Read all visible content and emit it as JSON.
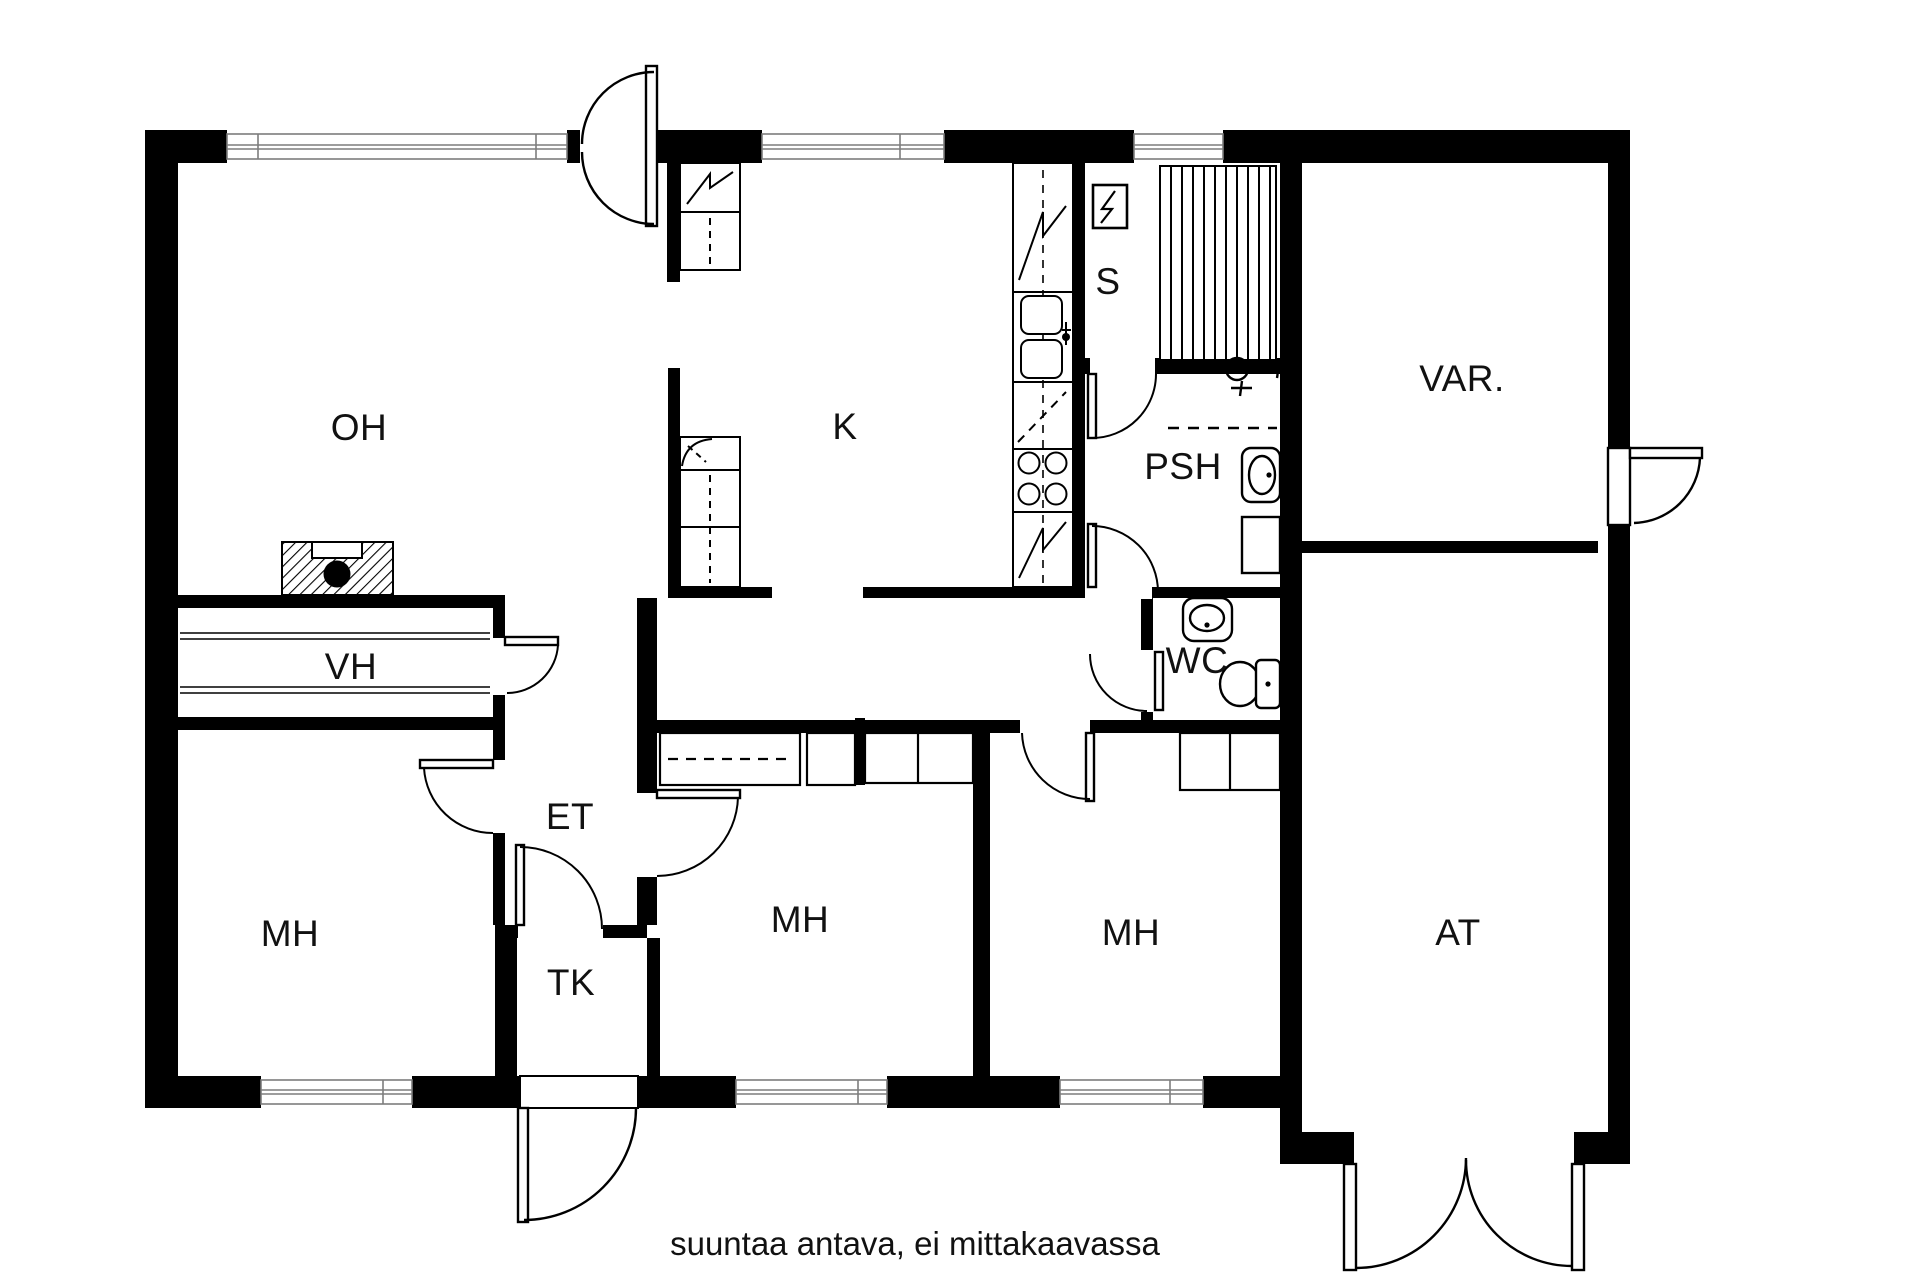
{
  "rooms": [
    {
      "id": "oh",
      "label": "OH",
      "meaning": "living room"
    },
    {
      "id": "k",
      "label": "K",
      "meaning": "kitchen"
    },
    {
      "id": "s",
      "label": "S",
      "meaning": "sauna"
    },
    {
      "id": "var",
      "label": "VAR.",
      "meaning": "storage"
    },
    {
      "id": "psh",
      "label": "PSH",
      "meaning": "washroom"
    },
    {
      "id": "wc",
      "label": "WC",
      "meaning": "toilet"
    },
    {
      "id": "vh",
      "label": "VH",
      "meaning": "closet room"
    },
    {
      "id": "et",
      "label": "ET",
      "meaning": "entry hall"
    },
    {
      "id": "tk",
      "label": "TK",
      "meaning": "vestibule"
    },
    {
      "id": "mh_left",
      "label": "MH",
      "meaning": "bedroom"
    },
    {
      "id": "mh_middle",
      "label": "MH",
      "meaning": "bedroom"
    },
    {
      "id": "mh_right",
      "label": "MH",
      "meaning": "bedroom"
    },
    {
      "id": "at",
      "label": "AT",
      "meaning": "garage"
    }
  ],
  "footer": {
    "note": "suuntaa antava, ei mittakaavassa"
  },
  "colors": {
    "wall": "#000000",
    "background": "#ffffff",
    "window_line": "#7d7d7d",
    "text": "#111111"
  },
  "fixtures": [
    "sauna-heater-icon",
    "sauna-benches",
    "kitchen-sink-icon",
    "stove-icon",
    "fridge-icon",
    "freezer-icon",
    "tall-cabinet",
    "fireplace-icon",
    "shower-icon",
    "shower-curtain-line",
    "washbasin-icon",
    "washing-machine-icon",
    "wc-washbasin-icon",
    "toilet-icon",
    "wardrobe",
    "closet",
    "shelves",
    "entrance-door",
    "garage-door",
    "exterior-door",
    "interior-door",
    "window"
  ]
}
